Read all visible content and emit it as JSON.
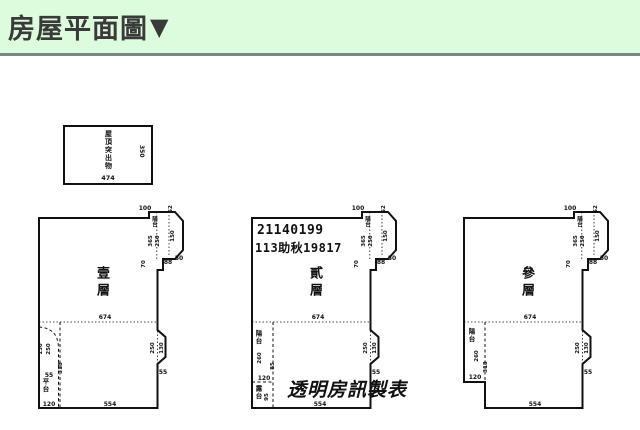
{
  "header": {
    "title": "房屋平面圖",
    "marker": "▼"
  },
  "colors": {
    "header_bg": "#ddfbdd",
    "header_line": "#77897c",
    "ink": "#111111"
  },
  "roof_box": {
    "label": "屋頂突出物",
    "width_dim": "474",
    "height_dim": "350"
  },
  "watermark": "透明房訊製表",
  "plans": [
    {
      "floor": "壹層",
      "bay_label": "陽台",
      "left_label": "平台",
      "dims": {
        "top": "100",
        "top_side": "52",
        "bay_a": "365",
        "bay_b": "250",
        "bay_c": "150",
        "bay_diag": "50",
        "bay_bottom": "88",
        "bay_side": "70",
        "mid": "674",
        "notch_a": "250",
        "notch_b": "130",
        "notch_bottom": "55",
        "bottom": "554",
        "left_a": "130",
        "left_b": "250",
        "left_small": "55",
        "left_tall": "318",
        "left_bottom": "120"
      }
    },
    {
      "floor": "貳層",
      "bay_label": "陽台",
      "left_label": "陽台",
      "left_label_bottom": "露台",
      "id_line1": "21140199",
      "id_line2": "113助秋19817",
      "dims": {
        "top": "100",
        "top_side": "52",
        "bay_a": "365",
        "bay_b": "250",
        "bay_c": "150",
        "bay_diag": "50",
        "bay_bottom": "88",
        "bay_side": "70",
        "mid": "674",
        "notch_a": "250",
        "notch_b": "130",
        "notch_bottom": "55",
        "bottom": "554",
        "left_a": "260",
        "left_b": "85",
        "left_mid": "120",
        "left_c": "95"
      }
    },
    {
      "floor": "參層",
      "bay_label": "陽台",
      "left_label": "陽台",
      "dims": {
        "top": "100",
        "top_side": "52",
        "bay_a": "365",
        "bay_b": "250",
        "bay_c": "150",
        "bay_diag": "50",
        "bay_bottom": "88",
        "bay_side": "70",
        "mid": "674",
        "notch_a": "250",
        "notch_b": "130",
        "notch_bottom": "55",
        "bottom": "554",
        "left_a": "260",
        "left_tall": "318",
        "left_bottom": "120"
      }
    }
  ]
}
